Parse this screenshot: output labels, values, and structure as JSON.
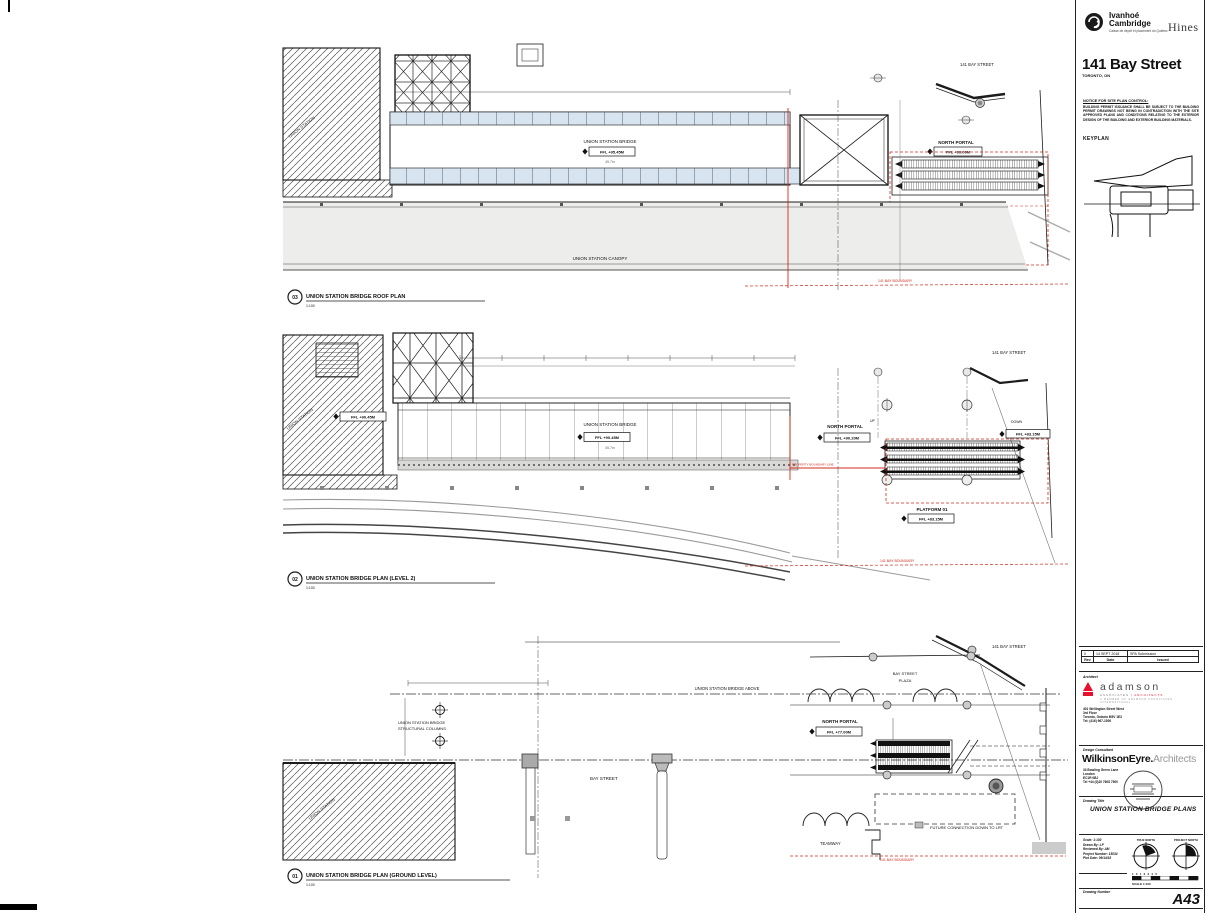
{
  "sheet": {
    "brand": {
      "ivanhoe_line1": "Ivanhoé",
      "ivanhoe_line2": "Cambridge",
      "ivanhoe_sub": "Caisse de dépôt et placement du Québec",
      "hines": "Hines"
    },
    "project": {
      "title": "141 Bay Street",
      "location": "TORONTO, ON"
    },
    "notice": {
      "heading": "NOTICE FOR SITE PLAN CONTROL:",
      "body": "BUILDING PERMIT ISSUANCE SHALL BE SUBJECT TO THE BUILDING PERMIT DRAWINGS NOT BEING IN CONTRADICTION WITH THE SITE APPROVED PLANS AND CONDITIONS RELATING TO THE EXTERIOR DESIGN OF THE BUILDING AND EXTERIOR BUILDING MATERIALS."
    },
    "keyplan_label": "KEYPLAN",
    "revisions": {
      "columns": [
        "Rev",
        "Date",
        "Issued"
      ],
      "rows": [
        [
          "0",
          "14 SEPT 2018",
          "SPA Submission"
        ]
      ]
    },
    "architect": {
      "label": "Architect",
      "name": "adamson",
      "sub1": "ASSOCIATES",
      "sub2": "ARCHITECTS",
      "tagline": "A MEMBER OF ADAMSON ASSOCIATES INTERNATIONAL",
      "addr1": "401 Wellington Street West",
      "addr2": "3rd Floor",
      "addr3": "Toronto, Ontario M5V 1E3",
      "addr4": "Tel: (416) 967-1500"
    },
    "consultant": {
      "label": "Design Consultant",
      "name": "WilkinsonEyre.",
      "name2": "Architects",
      "addr1": "33 Bowling Green Lane",
      "addr2": "London",
      "addr3": "EC1R 0BJ",
      "addr4": "Tel +44 (0)20 7608 7900"
    },
    "drawing_title": {
      "label": "Drawing Title",
      "value": "UNION STATION BRIDGE PLANS"
    },
    "info": {
      "line1": "Scale: 1:100",
      "line2": "Drawn By: LP",
      "line3": "Reviewed By: AM",
      "line4": "Project Number: 15034",
      "line5": "Plot Date: 09/14/18"
    },
    "north": {
      "true_label": "TRUE NORTH",
      "project_label": "PROJECT NORTH"
    },
    "scalebar": {
      "numbers": "1   0   1   2   3   4   5",
      "label": "SCALE 1:100",
      "unit": "m"
    },
    "drawing_number": {
      "label": "Drawing Number",
      "value": "A43"
    }
  },
  "plans": {
    "roof": {
      "tag": "03",
      "title": "UNION STATION BRIDGE ROOF PLAN",
      "scale": "1:100",
      "union_station": "UNION STATION",
      "bridge": "UNION STATION BRIDGE",
      "bridge_ffl": "FFL +95.45M",
      "bridge_dim": "45.7m",
      "north_portal": "NORTH PORTAL",
      "north_portal_ffl": "FFL +90.00M",
      "platform": "PLATFORM 01",
      "platform_ffl": "FFL +83.15M",
      "canopy": "UNION STATION CANOPY",
      "bay_street_141": "141 BAY STREET",
      "boundary": "141 BAY BOUNDARY"
    },
    "level2": {
      "tag": "02",
      "title": "UNION STATION BRIDGE PLAN (LEVEL 2)",
      "scale": "1:100",
      "union_station": "UNION STATION",
      "station_ffl": "FFL +90.45M",
      "bridge": "UNION STATION BRIDGE",
      "bridge_ffl": "FFL +90.45M",
      "bridge_dim": "45.7m",
      "north_portal": "NORTH PORTAL",
      "north_portal_ffl": "FFL +90.20M",
      "up": "UP",
      "down": "DOWN",
      "down_ffl": "FFL +83.15M",
      "platform": "PLATFORM 01",
      "platform_ffl": "FFL +83.15M",
      "boundary_line": "PROPERTY BOUNDARY LINE",
      "bay_street_141": "141 BAY STREET",
      "boundary": "141 BAY BOUNDARY"
    },
    "ground": {
      "tag": "01",
      "title": "UNION STATION BRIDGE PLAN (GROUND LEVEL)",
      "scale": "1:100",
      "union_station": "UNION STATION",
      "bridge_above": "UNION STATION BRIDGE ABOVE",
      "columns_l1": "UNION STATION BRIDGE",
      "columns_l2": "STRUCTURAL COLUMNS",
      "bay_street": "BAY STREET",
      "plaza_l1": "BAY STREET",
      "plaza_l2": "PLAZA",
      "north_portal": "NORTH PORTAL",
      "north_portal_ffl": "FFL +77.00M",
      "future_connection": "FUTURE CONNECTION DOWN TO LRT",
      "teamway": "TEAMWAY",
      "bay_street_141": "141 BAY STREET",
      "boundary": "141 BAY BOUNDARY"
    }
  }
}
